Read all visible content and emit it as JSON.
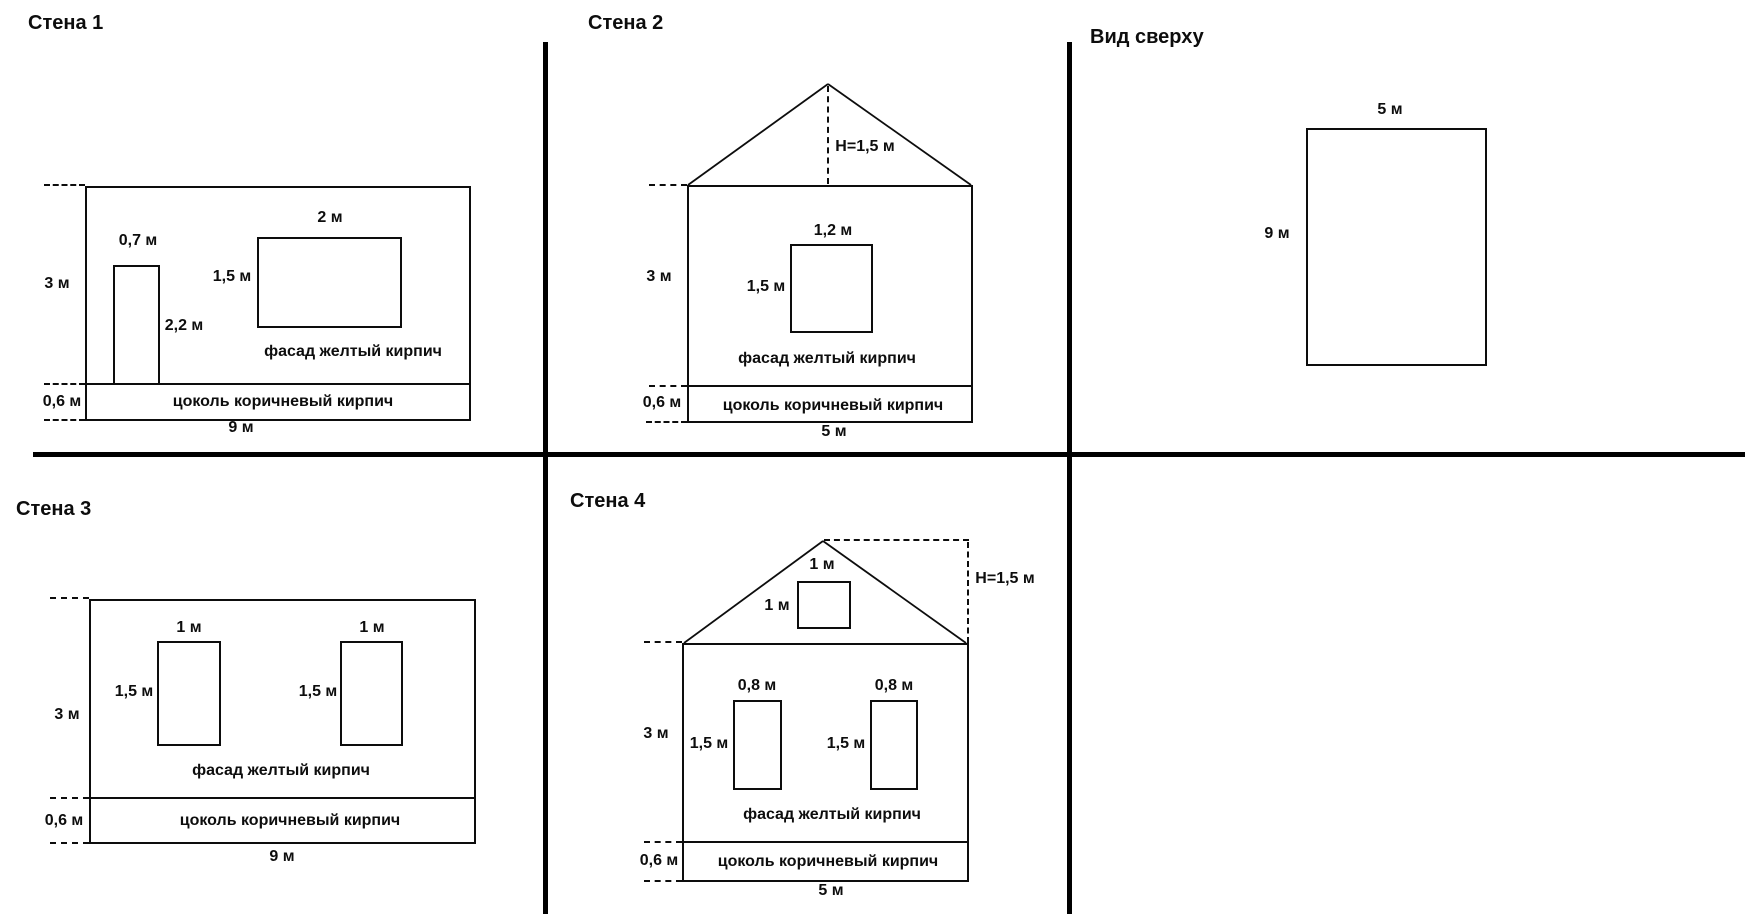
{
  "background": "#ffffff",
  "line_color": "#000000",
  "wall1": {
    "title": "Стена 1",
    "height_label": "3 м",
    "door_width_label": "0,7 м",
    "door_height_label": "2,2 м",
    "window_width_label": "2 м",
    "window_height_label": "1,5 м",
    "facade_label": "фасад желтый кирпич",
    "plinth_height_label": "0,6 м",
    "plinth_label": "цоколь коричневый кирпич",
    "width_label": "9 м"
  },
  "wall2": {
    "title": "Стена 2",
    "roof_height_label": "H=1,5 м",
    "height_label": "3 м",
    "window_width_label": "1,2 м",
    "window_height_label": "1,5 м",
    "facade_label": "фасад желтый кирпич",
    "plinth_height_label": "0,6 м",
    "plinth_label": "цоколь коричневый кирпич",
    "width_label": "5 м"
  },
  "top_view": {
    "title": "Вид сверху",
    "width_label": "5 м",
    "depth_label": "9 м"
  },
  "wall3": {
    "title": "Стена 3",
    "height_label": "3 м",
    "window1_width_label": "1 м",
    "window2_width_label": "1 м",
    "window1_height_label": "1,5 м",
    "window2_height_label": "1,5 м",
    "facade_label": "фасад желтый кирпич",
    "plinth_height_label": "0,6 м",
    "plinth_label": "цоколь коричневый кирпич",
    "width_label": "9 м"
  },
  "wall4": {
    "title": "Стена 4",
    "roof_height_label": "H=1,5 м",
    "attic_window_width_label": "1 м",
    "attic_window_height_label": "1 м",
    "height_label": "3 м",
    "window1_width_label": "0,8 м",
    "window2_width_label": "0,8 м",
    "window1_height_label": "1,5 м",
    "window2_height_label": "1,5 м",
    "facade_label": "фасад желтый кирпич",
    "plinth_height_label": "0,6 м",
    "plinth_label": "цоколь коричневый кирпич",
    "width_label": "5 м"
  }
}
